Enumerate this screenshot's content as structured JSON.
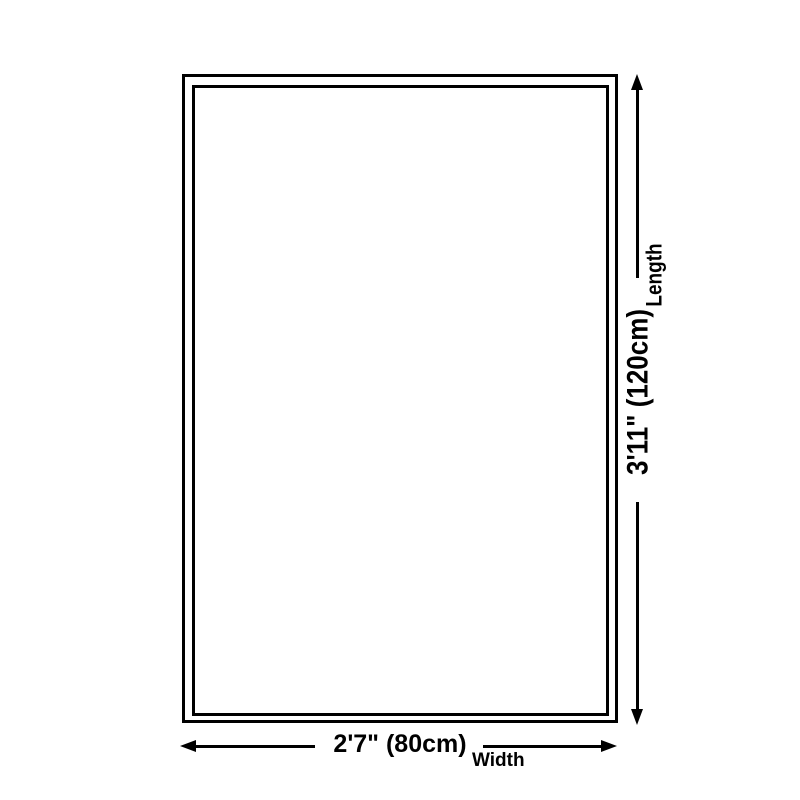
{
  "figure": {
    "type": "product-dimension-diagram",
    "background_color": "#ffffff",
    "stroke_color": "#000000",
    "length": {
      "value": "3'11\" (120cm)",
      "label": "Length"
    },
    "width": {
      "value": "2'7\" (80cm)",
      "label": "Width"
    }
  }
}
